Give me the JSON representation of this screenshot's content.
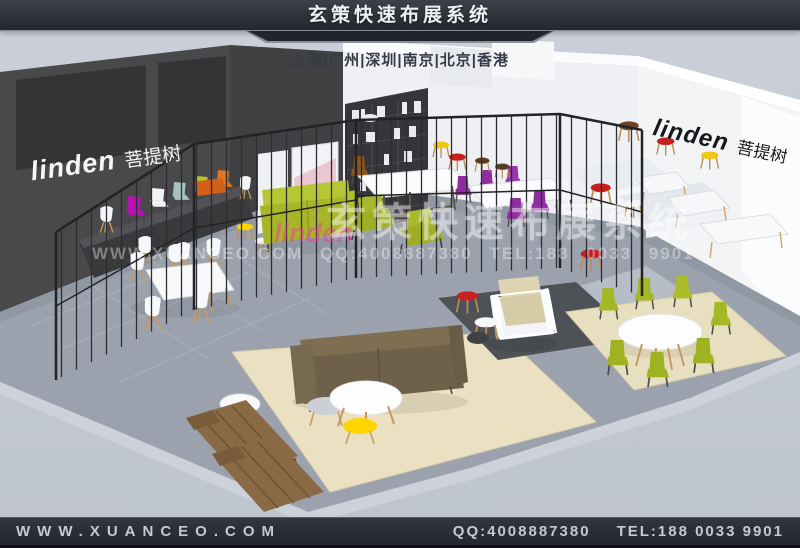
{
  "header": {
    "title": "玄策快速布展系统"
  },
  "cities_bar": {
    "text": "上海|广州|深圳|南京|北京|香港"
  },
  "booth": {
    "left_wall": {
      "brand": "linden",
      "brand_cn": "菩提树"
    },
    "right_wall": {
      "brand": "linden",
      "brand_cn": "菩提树"
    }
  },
  "watermark": {
    "brand": "linden",
    "title": "玄策快速布展系统",
    "contact": "WWW.XUANCEO.COM QQ:4008887380 TEL:188 0033 9901"
  },
  "footer": {
    "website": "WWW.XUANCEO.COM",
    "qq": "QQ:4008887380",
    "tel": "TEL:188 0033 9901"
  },
  "palette": {
    "header_bg": "#2c313a",
    "footer_bg": "#262b33",
    "scene_bg": "#c6cbd4",
    "dark_wall": "#49494c",
    "white_wall": "#f0f2f4",
    "floor": "#9ba2ae",
    "rug_beige": "#ebe1c2",
    "rug_dark": "#4e5156",
    "lime": "#aebd2c",
    "purple": "#8e2da0",
    "magenta": "#b911b3",
    "orange": "#e2761f",
    "yellow": "#ffd400",
    "red": "#c62222",
    "sofa_brown": "#7d6d50",
    "wood": "#c59a5f"
  }
}
